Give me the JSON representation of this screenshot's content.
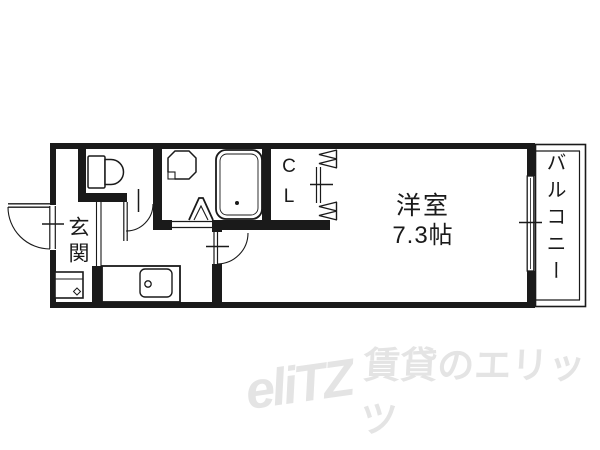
{
  "floor_plan": {
    "western_room": {
      "name": "洋室",
      "size": "7.3帖"
    },
    "closet": {
      "label": "C\nL"
    },
    "entrance": {
      "label": "玄関"
    },
    "balcony": {
      "label": "バルコニー"
    },
    "fixtures": [
      "toilet",
      "wash-basin",
      "bathtub",
      "kitchen-sink",
      "washing-machine-space"
    ],
    "doors": [
      "front-door",
      "toilet-door",
      "bathroom-folding-door",
      "room-door",
      "closet-accordion-door",
      "balcony-sliding-window"
    ]
  },
  "watermark": {
    "logo": "eliTZ",
    "text": "賃貸のエリッツ"
  },
  "colors": {
    "line": "#1a1a1a",
    "background": "#ffffff",
    "watermark": "#e4e4e4"
  }
}
